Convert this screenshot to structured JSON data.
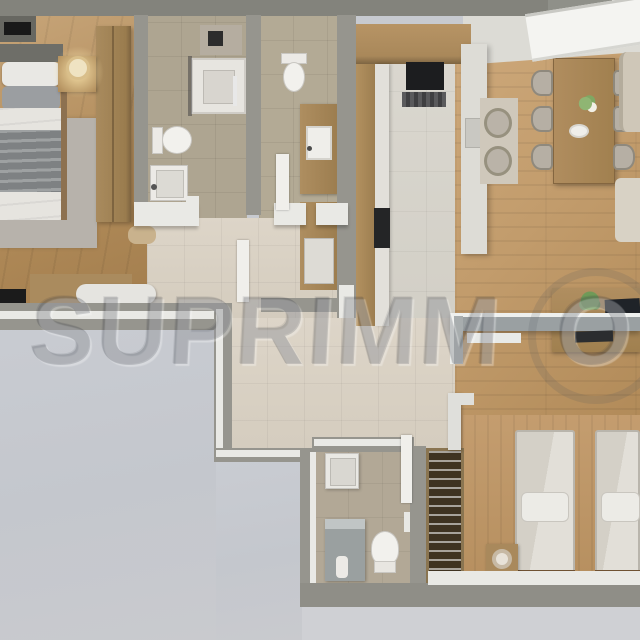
{
  "meta": {
    "title": "Two-bedroom apartment — top-down 3D floor plan render"
  },
  "watermark": {
    "brand": "SUPRIMMO",
    "left": "SUPRIMM",
    "o": "O"
  },
  "palette": {
    "top_band": "#83837c",
    "wall": "#96958e",
    "wall_top": "#e9e9e5",
    "terrace": "#c7cad0",
    "tile_bath": "#aea591",
    "tile_hall": "#d9d1c3",
    "wood_living": "#c29c6c",
    "wood_bedroom": "#b08a58",
    "cabinet_wood": "#ab8a5d",
    "counter_white": "#dddcd6",
    "appliance_black": "#1c1d1f",
    "plant_green": "#6f9a58"
  },
  "rooms": [
    {
      "id": "master-bedroom",
      "furniture": [
        "double-bed",
        "pillows",
        "gray-blanket",
        "rug",
        "nightstand",
        "table-lamp",
        "wardrobe",
        "desk",
        "desk-chair",
        "laptop",
        "pouf",
        "headboard-shelf"
      ]
    },
    {
      "id": "bathroom-1",
      "furniture": [
        "shower",
        "toilet",
        "washbasin",
        "towel-rail"
      ]
    },
    {
      "id": "bathroom-2",
      "furniture": [
        "toilet",
        "vanity-washbasin",
        "storage-cabinet"
      ]
    },
    {
      "id": "kitchen",
      "furniture": [
        "upper-cabinets",
        "oven",
        "cooker-hood",
        "counter-run",
        "cooktop",
        "peninsula-counter"
      ]
    },
    {
      "id": "dining-area",
      "furniture": [
        "dining-table",
        "six-chairs",
        "two-armchairs",
        "rug",
        "sofa",
        "flower-vase",
        "plate",
        "skylight-window"
      ]
    },
    {
      "id": "living-area",
      "furniture": [
        "media-cabinet",
        "wall-console-shelf",
        "tv",
        "plant"
      ]
    },
    {
      "id": "kids-bedroom",
      "furniture": [
        "single-bed-1",
        "single-bed-2",
        "nightstand",
        "round-lamp",
        "open-wardrobe-with-hangers"
      ]
    },
    {
      "id": "bathroom-3",
      "furniture": [
        "washbasin-cabinet",
        "shower-cabin",
        "toilet",
        "towel-rail"
      ]
    },
    {
      "id": "terrace-roof",
      "furniture": []
    }
  ]
}
